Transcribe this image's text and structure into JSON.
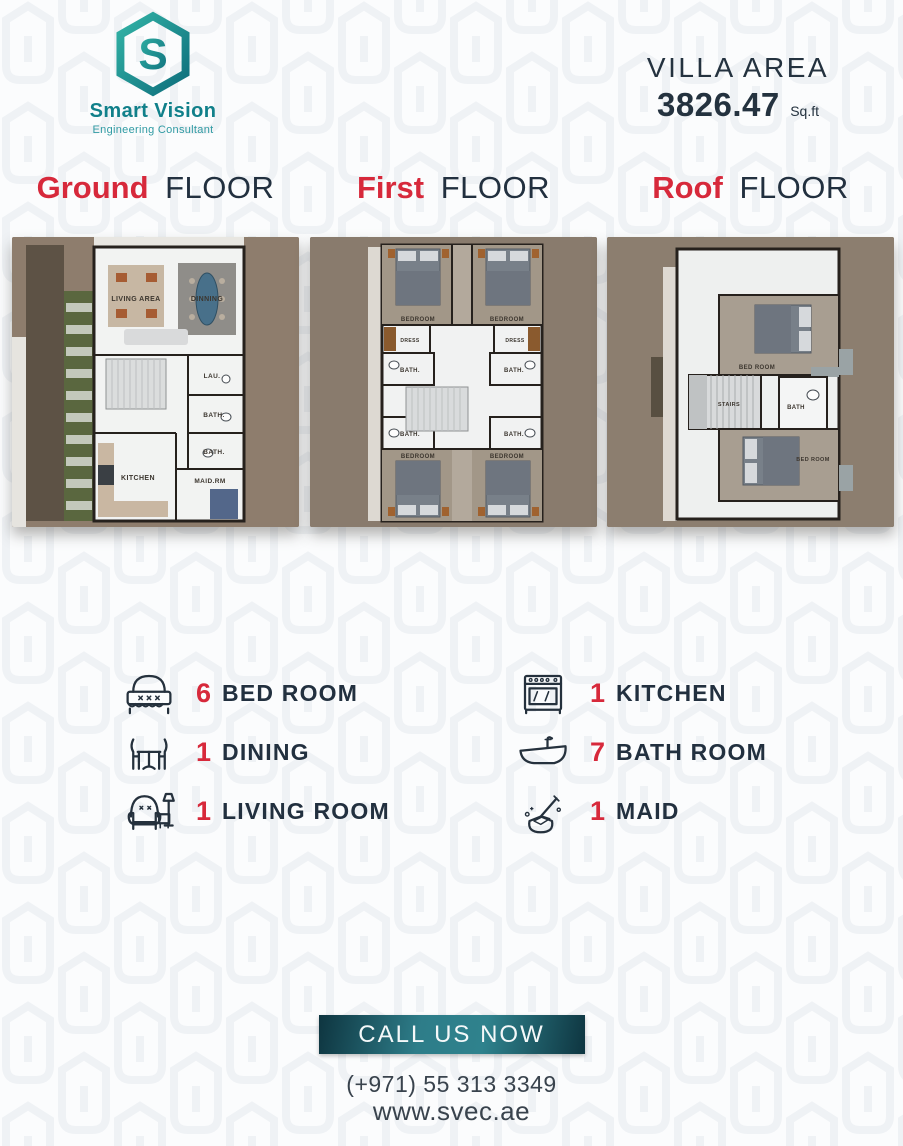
{
  "brand": {
    "name": "Smart Vision",
    "tagline": "Engineering Consultant"
  },
  "villa": {
    "label": "VILLA AREA",
    "value": "3826.47",
    "unit": "Sq.ft"
  },
  "floors": [
    {
      "title_highlight": "Ground",
      "title_rest": "FLOOR",
      "rooms": [
        "LIVING AREA",
        "DINNING",
        "LAU.",
        "BATH.",
        "BATH.",
        "KITCHEN",
        "MAID.RM"
      ]
    },
    {
      "title_highlight": "First",
      "title_rest": "FLOOR",
      "rooms": [
        "BEDROOM",
        "BEDROOM",
        "DRESS",
        "DRESS",
        "BATH.",
        "BATH.",
        "BATH.",
        "BATH.",
        "BEDROOM",
        "BEDROOM"
      ]
    },
    {
      "title_highlight": "Roof",
      "title_rest": "FLOOR",
      "rooms": [
        "BED ROOM",
        "STAIRS",
        "BATH",
        "BED ROOM"
      ]
    }
  ],
  "legend": {
    "left": [
      {
        "icon": "bed-icon",
        "count": "6",
        "label": "BED ROOM"
      },
      {
        "icon": "dining-icon",
        "count": "1",
        "label": "DINING"
      },
      {
        "icon": "living-room-icon",
        "count": "1",
        "label": "LIVING ROOM"
      }
    ],
    "right": [
      {
        "icon": "kitchen-icon",
        "count": "1",
        "label": "KITCHEN"
      },
      {
        "icon": "bath-icon",
        "count": "7",
        "label": "BATH ROOM"
      },
      {
        "icon": "maid-icon",
        "count": "1",
        "label": "MAID"
      }
    ]
  },
  "cta": {
    "button": "CALL US NOW",
    "phone": "(+971) 55 313 3349",
    "website": "www.svec.ae"
  },
  "colors": {
    "accent_red": "#d7293b",
    "dark_navy": "#22303f",
    "brand_teal": "#11808a",
    "button_teal": "#2e7d89",
    "plan_brown": "#8e7d6d",
    "pattern_gray": "#edf0f4"
  }
}
